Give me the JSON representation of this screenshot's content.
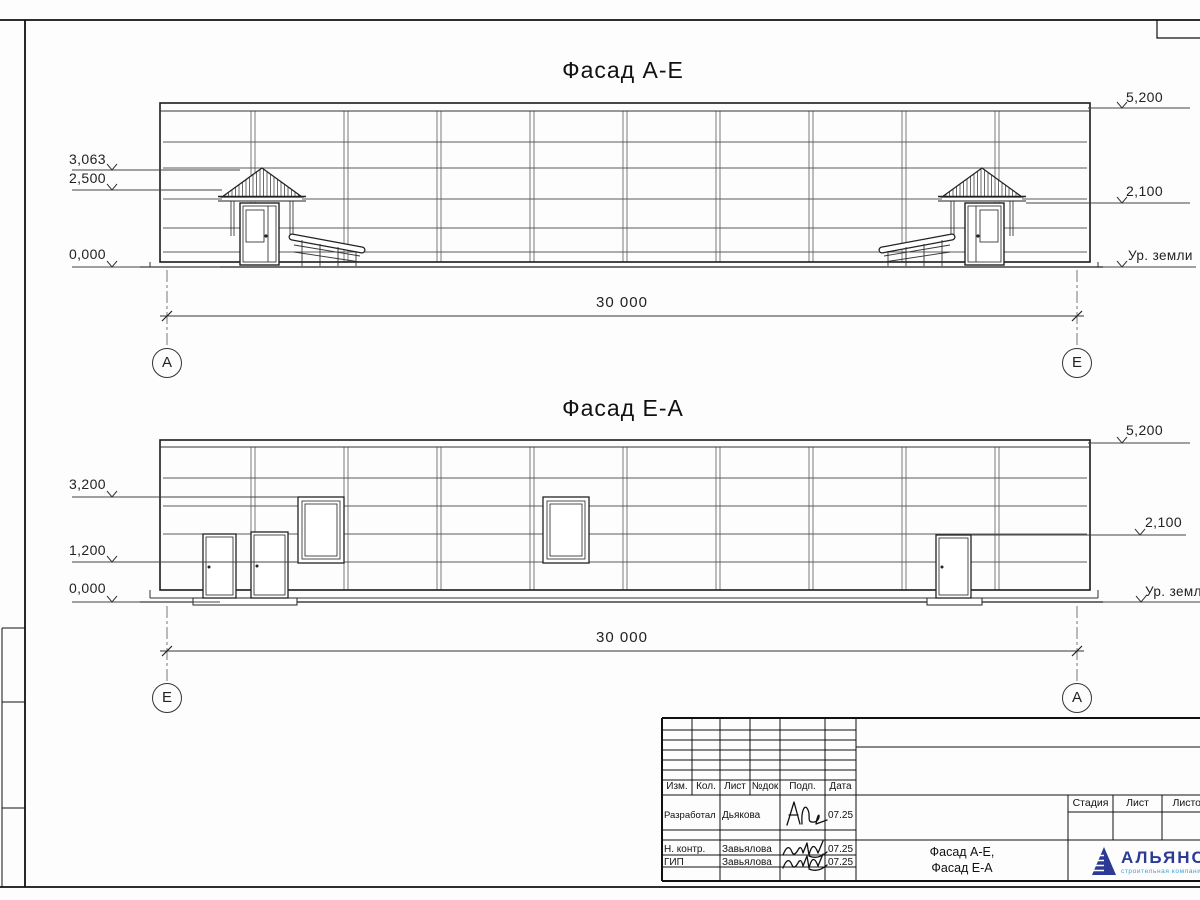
{
  "facades": {
    "top": {
      "title": "Фасад А-Е",
      "axis_left": "А",
      "axis_right": "Е",
      "width_label": "30 000",
      "levels_left": [
        "3,063",
        "2,500",
        "0,000"
      ],
      "levels_right": [
        "5,200",
        "2,100"
      ],
      "ground_label": "Ур. земли"
    },
    "bottom": {
      "title": "Фасад Е-А",
      "axis_left": "Е",
      "axis_right": "А",
      "width_label": "30 000",
      "levels_left": [
        "3,200",
        "1,200",
        "0,000"
      ],
      "levels_right": [
        "5,200",
        "2,100"
      ],
      "ground_label": "Ур. земли"
    }
  },
  "title_block": {
    "columns": [
      "Изм.",
      "Кол.",
      "Лист",
      "№док",
      "Подп.",
      "Дата"
    ],
    "signature_rows": [
      {
        "role": "Разработал",
        "name": "Дьякова",
        "date": "07.25"
      },
      {
        "role": "Н. контр.",
        "name": "Завьялова",
        "date": "07.25"
      },
      {
        "role": "ГИП",
        "name": "Завьялова",
        "date": "07.25"
      }
    ],
    "doc_name_line1": "Фасад А-Е,",
    "doc_name_line2": "Фасад Е-А",
    "stage_cols": [
      "Стадия",
      "Лист",
      "Листов"
    ],
    "company": {
      "name": "АЛЬЯНС",
      "tagline": "строительная компания",
      "brand_color": "#2b3a94",
      "accent_color": "#3f9fd8"
    }
  }
}
